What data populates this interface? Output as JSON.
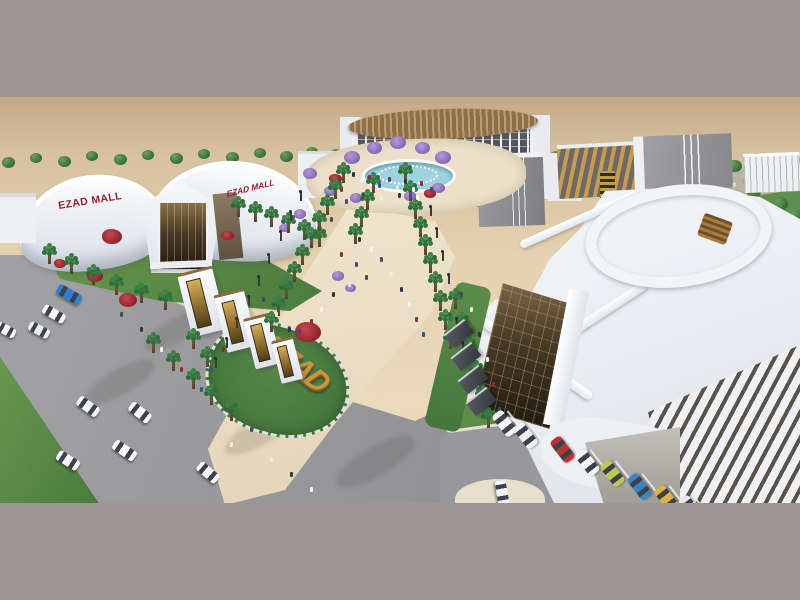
{
  "labels": {
    "mall_sign_left": "EZAD MALL",
    "mall_sign_right": "EZAD MALL",
    "monument": "EZAD"
  },
  "colors": {
    "frame_gray": "#9d9694",
    "sand_light": "#ead9bb",
    "sand_dark": "#c2aa89",
    "building_white": "#f3f4f7",
    "sign_red": "#8e2130",
    "gold": "#c9963f",
    "bronze_glass": "#4a3a24",
    "lawn_green": "#5c8c4a",
    "palm_green": "#37773f",
    "road_gray": "#9b9b9d",
    "paving_beige": "#ecdfc8",
    "water_blue": "#9ed2e0",
    "louver_dark": "#56524c",
    "purple_tree": "#8a6fb8",
    "red_flower": "#9a2730"
  },
  "scene": {
    "people_palette": [
      "#2e3440",
      "#f5f5f5",
      "#8a2f2f",
      "#31517f",
      "#444b55",
      "#f0ead9"
    ],
    "back_trees": [
      [
        8,
        66,
        13
      ],
      [
        36,
        62,
        12
      ],
      [
        64,
        65,
        13
      ],
      [
        92,
        60,
        12
      ],
      [
        120,
        63,
        13
      ],
      [
        148,
        59,
        12
      ],
      [
        176,
        62,
        13
      ],
      [
        204,
        58,
        12
      ],
      [
        232,
        61,
        13
      ],
      [
        260,
        57,
        12
      ],
      [
        286,
        60,
        13
      ],
      [
        312,
        56,
        12
      ],
      [
        336,
        58,
        12
      ],
      [
        556,
        60,
        12
      ],
      [
        578,
        56,
        12
      ]
    ],
    "right_trees": [
      [
        598,
        68,
        13
      ],
      [
        620,
        62,
        12
      ],
      [
        644,
        58,
        13
      ],
      [
        668,
        56,
        12
      ],
      [
        690,
        66,
        14
      ],
      [
        712,
        60,
        13
      ],
      [
        734,
        70,
        15
      ],
      [
        756,
        62,
        13
      ],
      [
        778,
        72,
        15
      ],
      [
        794,
        64,
        13
      ],
      [
        700,
        96,
        14
      ],
      [
        726,
        104,
        15
      ],
      [
        754,
        96,
        14
      ],
      [
        780,
        108,
        16
      ],
      [
        690,
        124,
        15
      ],
      [
        718,
        130,
        16
      ],
      [
        748,
        124,
        15
      ],
      [
        778,
        132,
        17
      ],
      [
        795,
        120,
        15
      ]
    ],
    "purple_trees": [
      [
        352,
        62,
        16
      ],
      [
        374,
        52,
        15
      ],
      [
        398,
        47,
        16
      ],
      [
        422,
        52,
        15
      ],
      [
        443,
        62,
        16
      ],
      [
        310,
        78,
        14
      ],
      [
        330,
        95,
        13
      ],
      [
        356,
        102,
        12
      ],
      [
        410,
        100,
        12
      ],
      [
        438,
        92,
        13
      ],
      [
        300,
        118,
        12
      ],
      [
        284,
        132,
        11
      ],
      [
        338,
        180,
        12
      ],
      [
        350,
        192,
        11
      ]
    ],
    "red_flowers": [
      [
        112,
        142,
        20
      ],
      [
        95,
        181,
        16
      ],
      [
        128,
        205,
        18
      ],
      [
        227,
        140,
        13
      ],
      [
        308,
        238,
        26
      ],
      [
        335,
        83,
        13
      ],
      [
        430,
        98,
        12
      ],
      [
        60,
        168,
        12
      ]
    ],
    "palms": [
      [
        237,
        108
      ],
      [
        254,
        113
      ],
      [
        270,
        118
      ],
      [
        287,
        124
      ],
      [
        303,
        131
      ],
      [
        318,
        138
      ],
      [
        342,
        74
      ],
      [
        334,
        90
      ],
      [
        326,
        106
      ],
      [
        318,
        122
      ],
      [
        310,
        139
      ],
      [
        301,
        156
      ],
      [
        293,
        173
      ],
      [
        285,
        190
      ],
      [
        277,
        207
      ],
      [
        270,
        223
      ],
      [
        404,
        74
      ],
      [
        409,
        92
      ],
      [
        414,
        110
      ],
      [
        419,
        128
      ],
      [
        424,
        146
      ],
      [
        429,
        164
      ],
      [
        434,
        183
      ],
      [
        439,
        202
      ],
      [
        444,
        221
      ],
      [
        449,
        240
      ],
      [
        372,
        84
      ],
      [
        366,
        101
      ],
      [
        360,
        118
      ],
      [
        354,
        135
      ],
      [
        48,
        155
      ],
      [
        70,
        165
      ],
      [
        92,
        176
      ],
      [
        115,
        186
      ],
      [
        140,
        194
      ],
      [
        164,
        201
      ],
      [
        152,
        244
      ],
      [
        172,
        262
      ],
      [
        192,
        280
      ],
      [
        210,
        296
      ],
      [
        454,
        200
      ],
      [
        461,
        224
      ],
      [
        468,
        248
      ],
      [
        475,
        272
      ],
      [
        481,
        296
      ],
      [
        487,
        319
      ],
      [
        192,
        240
      ],
      [
        206,
        258
      ],
      [
        230,
        312
      ]
    ],
    "people": [
      [
        352,
        75
      ],
      [
        360,
        82
      ],
      [
        368,
        78
      ],
      [
        378,
        86
      ],
      [
        388,
        80
      ],
      [
        396,
        88
      ],
      [
        404,
        82
      ],
      [
        412,
        90
      ],
      [
        420,
        84
      ],
      [
        430,
        90
      ],
      [
        362,
        96
      ],
      [
        380,
        98
      ],
      [
        398,
        96
      ],
      [
        416,
        98
      ],
      [
        340,
        90
      ],
      [
        345,
        102
      ],
      [
        330,
        120
      ],
      [
        345,
        130
      ],
      [
        358,
        140
      ],
      [
        370,
        150
      ],
      [
        340,
        155
      ],
      [
        355,
        165
      ],
      [
        365,
        178
      ],
      [
        348,
        185
      ],
      [
        332,
        195
      ],
      [
        320,
        210
      ],
      [
        310,
        222
      ],
      [
        298,
        232
      ],
      [
        380,
        160
      ],
      [
        390,
        175
      ],
      [
        400,
        190
      ],
      [
        408,
        205
      ],
      [
        415,
        220
      ],
      [
        422,
        235
      ],
      [
        262,
        200
      ],
      [
        275,
        215
      ],
      [
        288,
        230
      ],
      [
        240,
        220
      ],
      [
        222,
        250
      ],
      [
        210,
        270
      ],
      [
        250,
        330
      ],
      [
        230,
        345
      ],
      [
        140,
        230
      ],
      [
        160,
        250
      ],
      [
        180,
        270
      ],
      [
        200,
        290
      ],
      [
        120,
        215
      ],
      [
        470,
        210
      ],
      [
        478,
        235
      ],
      [
        486,
        260
      ],
      [
        492,
        285
      ],
      [
        498,
        310
      ],
      [
        460,
        195
      ],
      [
        270,
        360
      ],
      [
        290,
        375
      ],
      [
        310,
        390
      ]
    ],
    "road_cars": [
      {
        "x": 56,
        "y": 192,
        "r": 30,
        "c": "#2d7fd3",
        "w": 26,
        "h": 11
      },
      {
        "x": 42,
        "y": 212,
        "r": 30,
        "c": "#f5f5f7",
        "w": 24,
        "h": 10
      },
      {
        "x": 28,
        "y": 228,
        "r": 28,
        "c": "#eceef0",
        "w": 22,
        "h": 10
      },
      {
        "x": -4,
        "y": 228,
        "r": 28,
        "c": "#f5f5f7",
        "w": 20,
        "h": 10
      },
      {
        "x": 76,
        "y": 304,
        "r": 36,
        "c": "#f3f4f6",
        "w": 24,
        "h": 11
      },
      {
        "x": 128,
        "y": 310,
        "r": 38,
        "c": "#f6f6f8",
        "w": 24,
        "h": 11
      },
      {
        "x": 112,
        "y": 348,
        "r": 34,
        "c": "#ffffff",
        "w": 25,
        "h": 11
      },
      {
        "x": 56,
        "y": 358,
        "r": 32,
        "c": "#f4f4f6",
        "w": 24,
        "h": 11
      },
      {
        "x": 196,
        "y": 370,
        "r": 40,
        "c": "#f6f6f8",
        "w": 24,
        "h": 11
      },
      {
        "x": 490,
        "y": 390,
        "r": 80,
        "c": "#f2f2f4",
        "w": 24,
        "h": 11
      }
    ],
    "parking_cars": [
      {
        "x": 498,
        "y": 313,
        "c": "#f7f7f9"
      },
      {
        "x": 519,
        "y": 325,
        "c": "#f1f1f3"
      },
      {
        "x": 556,
        "y": 339,
        "c": "#b5342f"
      },
      {
        "x": 581,
        "y": 352,
        "c": "#f5f5f7"
      },
      {
        "x": 606,
        "y": 363,
        "c": "#b9cb55"
      },
      {
        "x": 633,
        "y": 376,
        "c": "#3f7fc4"
      },
      {
        "x": 660,
        "y": 388,
        "c": "#d9b43e"
      },
      {
        "x": 684,
        "y": 398,
        "c": "#e8e8ea"
      }
    ],
    "dist_cars": [
      [
        692,
        80,
        "#c34038"
      ],
      [
        704,
        84,
        "#ffffff"
      ],
      [
        716,
        80,
        "#3a62b5"
      ],
      [
        728,
        86,
        "#d9d9db"
      ],
      [
        742,
        82,
        "#caa84a"
      ],
      [
        754,
        88,
        "#8a8a8c"
      ],
      [
        768,
        84,
        "#ffffff"
      ],
      [
        700,
        102,
        "#ffffff"
      ],
      [
        714,
        106,
        "#b5342f"
      ],
      [
        730,
        104,
        "#4a7fc1"
      ]
    ],
    "gate_pylons": [
      {
        "x": 184,
        "y": 172,
        "w": 36,
        "h": 62
      },
      {
        "x": 220,
        "y": 194,
        "w": 31,
        "h": 56
      },
      {
        "x": 249,
        "y": 218,
        "w": 27,
        "h": 49
      },
      {
        "x": 276,
        "y": 241,
        "w": 22,
        "h": 41
      }
    ],
    "lamps": [
      [
        300,
        95
      ],
      [
        290,
        115
      ],
      [
        280,
        135
      ],
      [
        268,
        158
      ],
      [
        258,
        180
      ],
      [
        248,
        200
      ],
      [
        430,
        110
      ],
      [
        436,
        132
      ],
      [
        442,
        155
      ],
      [
        448,
        178
      ],
      [
        236,
        222
      ],
      [
        226,
        242
      ],
      [
        215,
        262
      ],
      [
        456,
        222
      ],
      [
        462,
        246
      ]
    ],
    "awnings": [
      [
        446,
        228
      ],
      [
        453,
        251
      ],
      [
        460,
        274
      ],
      [
        468,
        296
      ]
    ],
    "shadows": [
      [
        140,
        222,
        70,
        24
      ],
      [
        80,
        272,
        80,
        26
      ],
      [
        220,
        322,
        80,
        26
      ],
      [
        330,
        350,
        90,
        30
      ]
    ]
  }
}
